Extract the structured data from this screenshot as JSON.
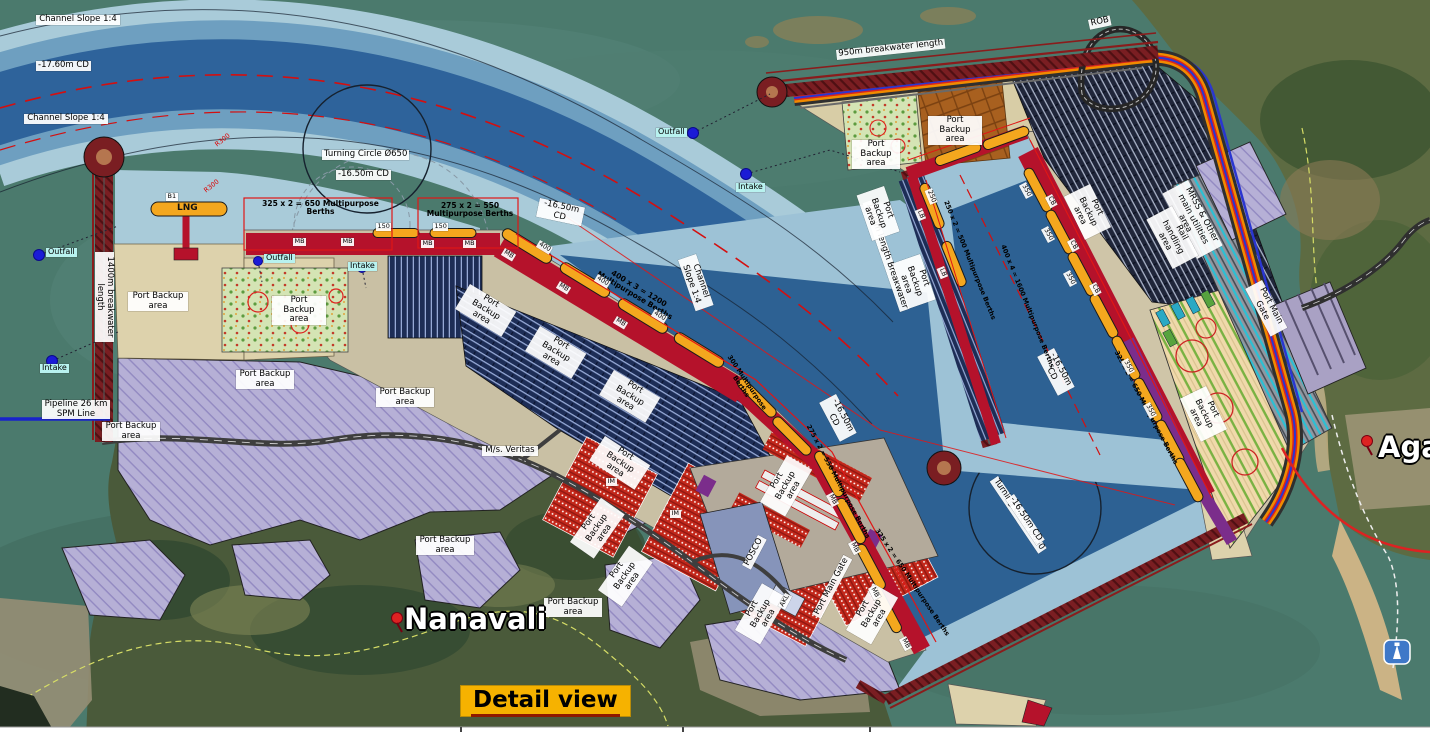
{
  "labels": {
    "channel_slope": "Channel Slope 1:4",
    "depth_channel": "-17.60m CD",
    "depth_basin": "-16.50m CD",
    "turning_circle": "Turning Circle Ø650",
    "berth_lng": "LNG",
    "berth_b1": "B1",
    "mpb_325": "325 x 2 = 650 Multipurpose Berths",
    "mpb_275": "275 x 2 = 550 Multipurpose Berths",
    "mpb_400x3": "400 x 3 = 1200 Multipurpose Berths",
    "mpb_400x4": "400 x 4 = 1600 Multipurpose Berths",
    "mpb_250": "250 x 2 = 500 Multipurpose Berths",
    "mpb_300": "300 Multipurpose Berths",
    "radius_300": "R300",
    "outfall": "Outfall",
    "intake": "Intake",
    "bw_west": "1400m breakwater length",
    "bw_north": "950m breakwater length",
    "bw_pier": "1600m length Breakwater",
    "port_backup": "Port Backup area",
    "veritas": "M/s. Veritas",
    "posco": "POSCO",
    "akl": "AKL",
    "im": "IM",
    "rob": "ROB",
    "mrss": "MRSS & Other main utilities area",
    "rail": "Rail handling area",
    "gate": "Port Main Gate",
    "pipeline": "Pipeline 26 km SPM Line",
    "berth_len_400": "400",
    "berth_len_350": "350",
    "berth_len_150": "150",
    "berth_len_250": "250",
    "berth_mb": "MB",
    "berth_cb": "CB",
    "berth_lb": "LB"
  },
  "places": {
    "village_left": "Nanavali",
    "village_right": "Agarwada"
  },
  "badge": {
    "detail_view": "Detail view"
  },
  "colors": {
    "sea": "#4b7a6d",
    "channel_dark": "#2e639b",
    "channel_light": "#a9cbd9",
    "quay_red": "#b5122b",
    "berth_orange": "#f4a71e",
    "breakwater": "#7a1e22",
    "backup_purple": "#b6b0d6",
    "backup_beige": "#ddd2ac",
    "badge_yellow": "#f6b200"
  }
}
